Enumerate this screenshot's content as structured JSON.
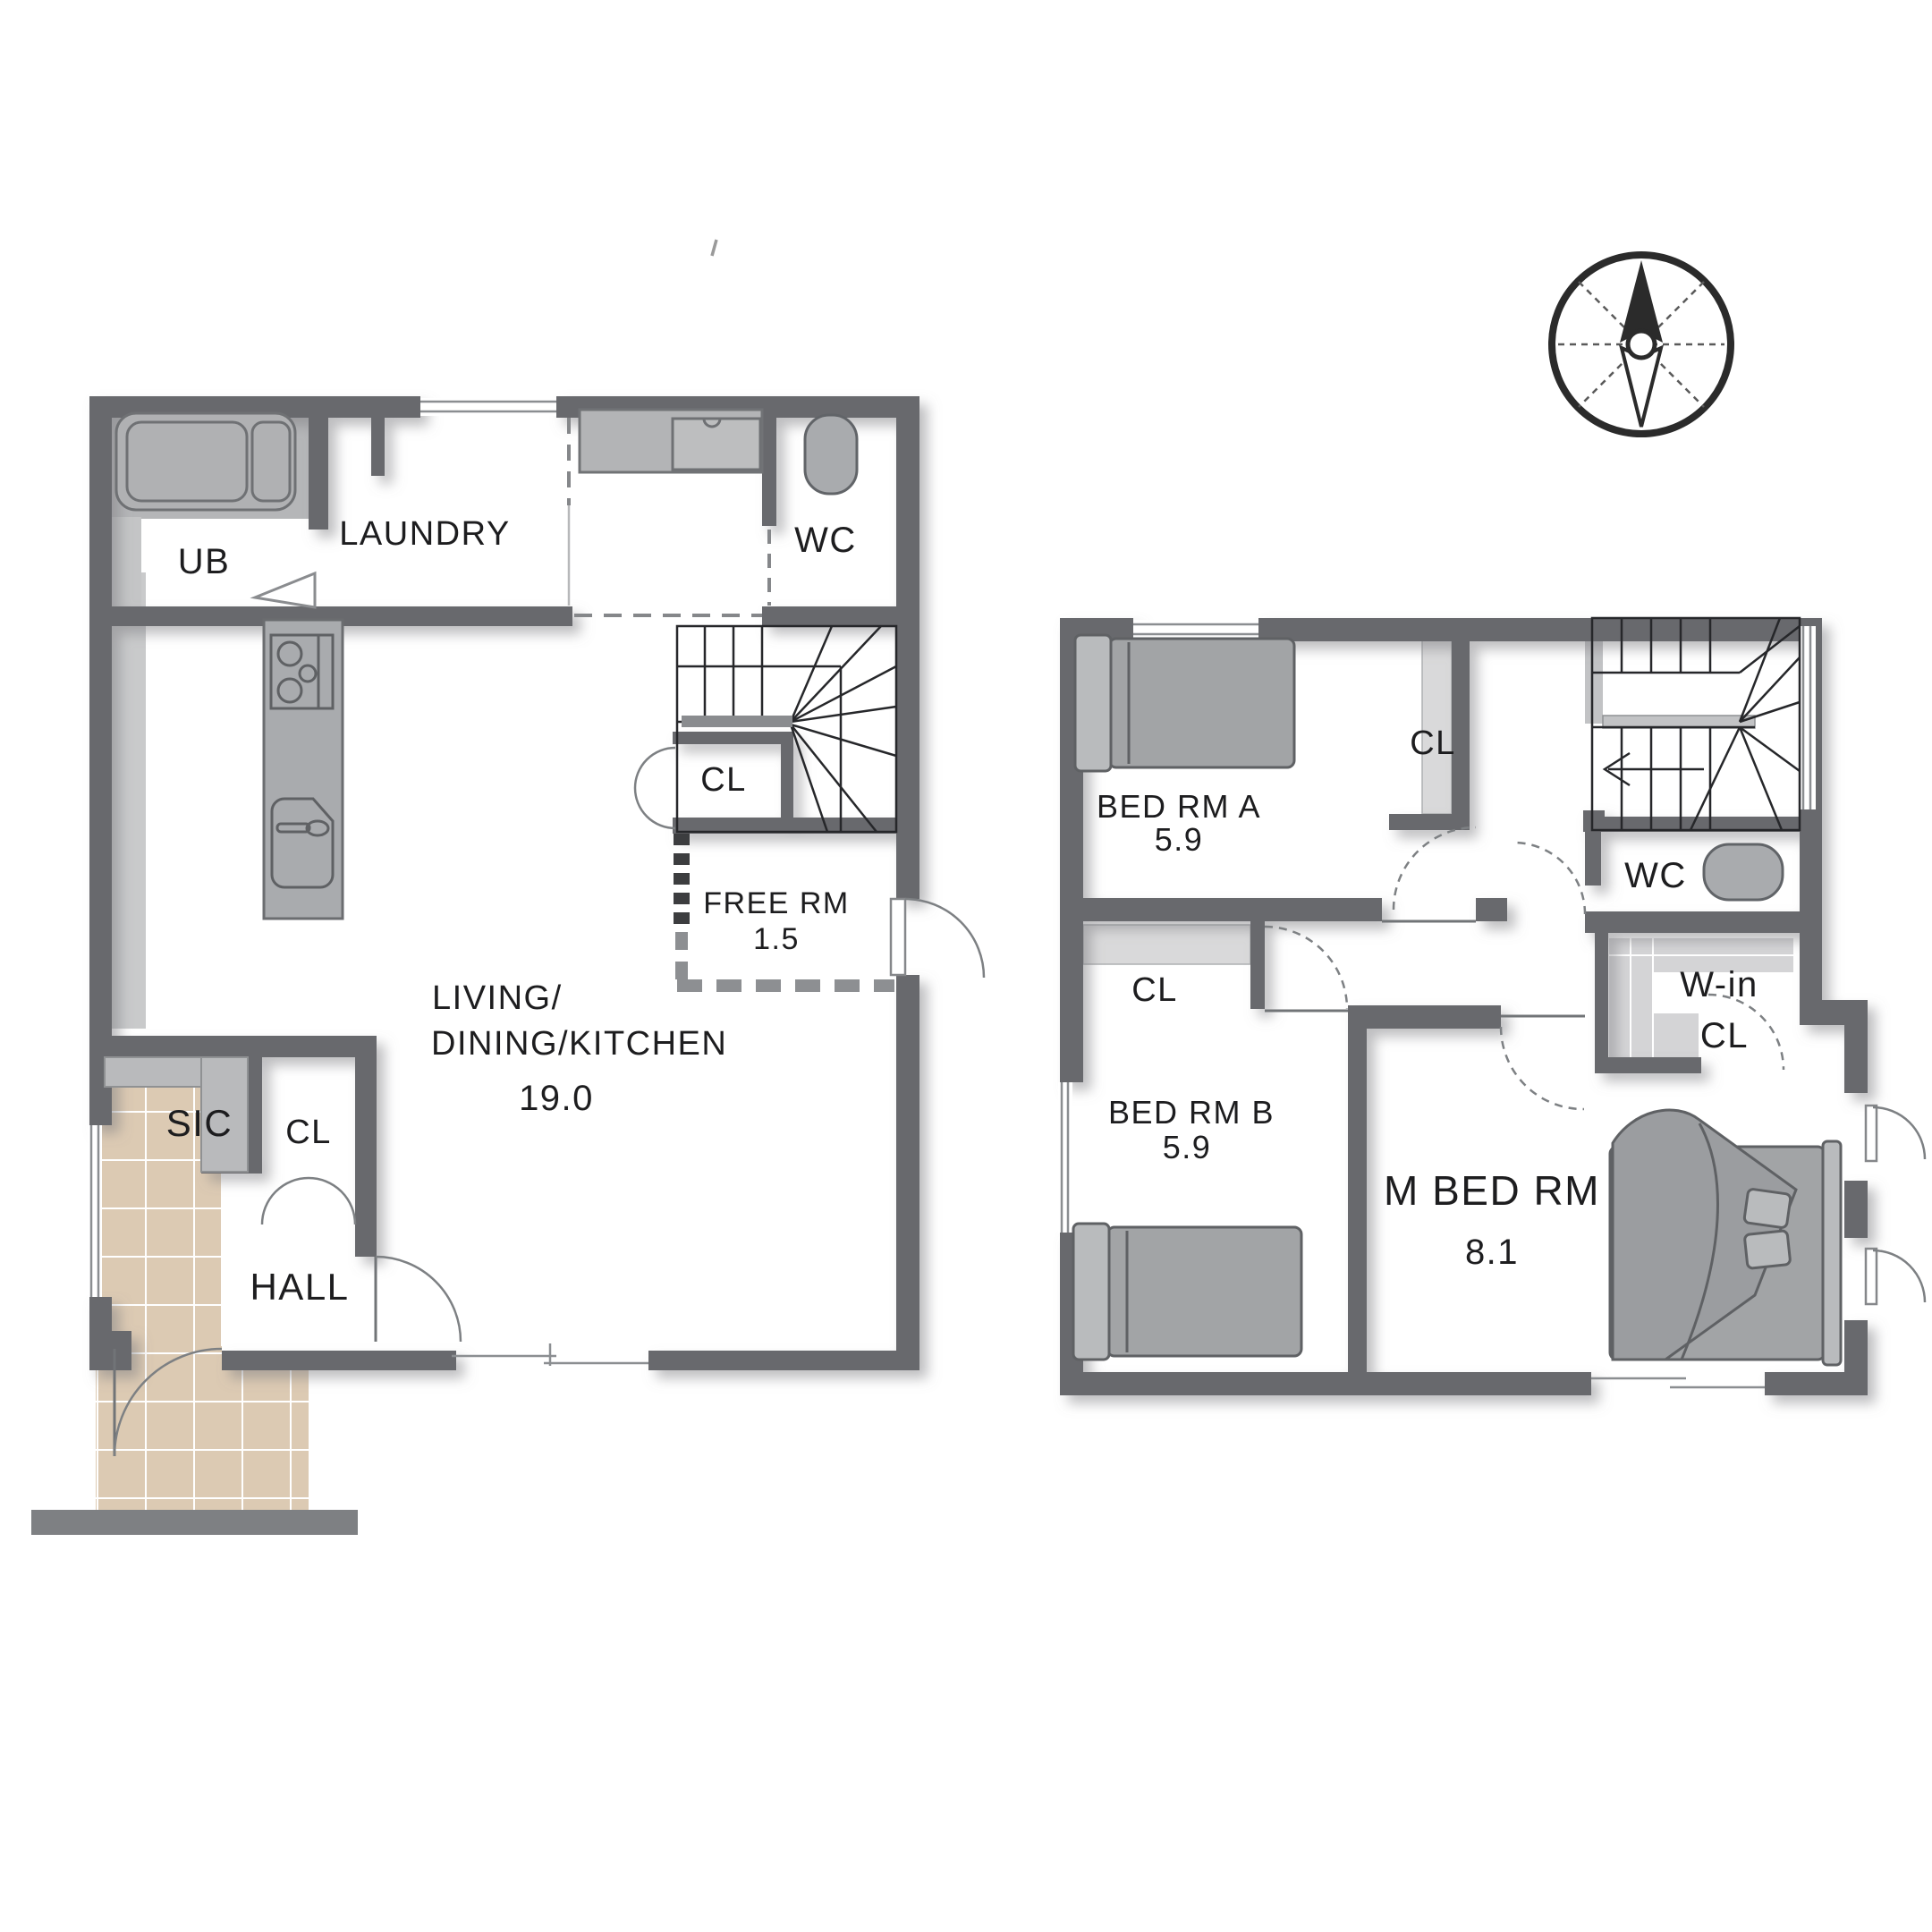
{
  "compass": {
    "north_label": "N"
  },
  "floor1": {
    "ub": {
      "label": "UB"
    },
    "laundry": {
      "label": "LAUNDRY"
    },
    "wc": {
      "label": "WC"
    },
    "stair_closet": {
      "label": "CL"
    },
    "free_room": {
      "label": "FREE RM",
      "area": "1.5"
    },
    "ldk": {
      "line1": "LIVING/",
      "line2": "DINING/KITCHEN",
      "area": "19.0"
    },
    "sic": {
      "label": "SIC"
    },
    "hall_closet": {
      "label": "CL"
    },
    "hall": {
      "label": "HALL"
    }
  },
  "floor2": {
    "bed_a": {
      "label": "BED RM A",
      "area": "5.9"
    },
    "closet_a": {
      "label": "CL"
    },
    "wc": {
      "label": "WC"
    },
    "walk_in": {
      "line1": "W-in",
      "line2": "CL"
    },
    "closet_b": {
      "label": "CL"
    },
    "bed_b": {
      "label": "BED RM B",
      "area": "5.9"
    },
    "master": {
      "label": "M BED RM",
      "area": "8.1"
    }
  },
  "colors": {
    "wall": "#67696d",
    "furniture_gray": "#a9abae",
    "closet_gray": "#d9d9da",
    "tile_beige": "#dccab3",
    "bed_gray": "#a2a4a6",
    "stair_line": "#26272a",
    "text": "#1d1d1f"
  }
}
